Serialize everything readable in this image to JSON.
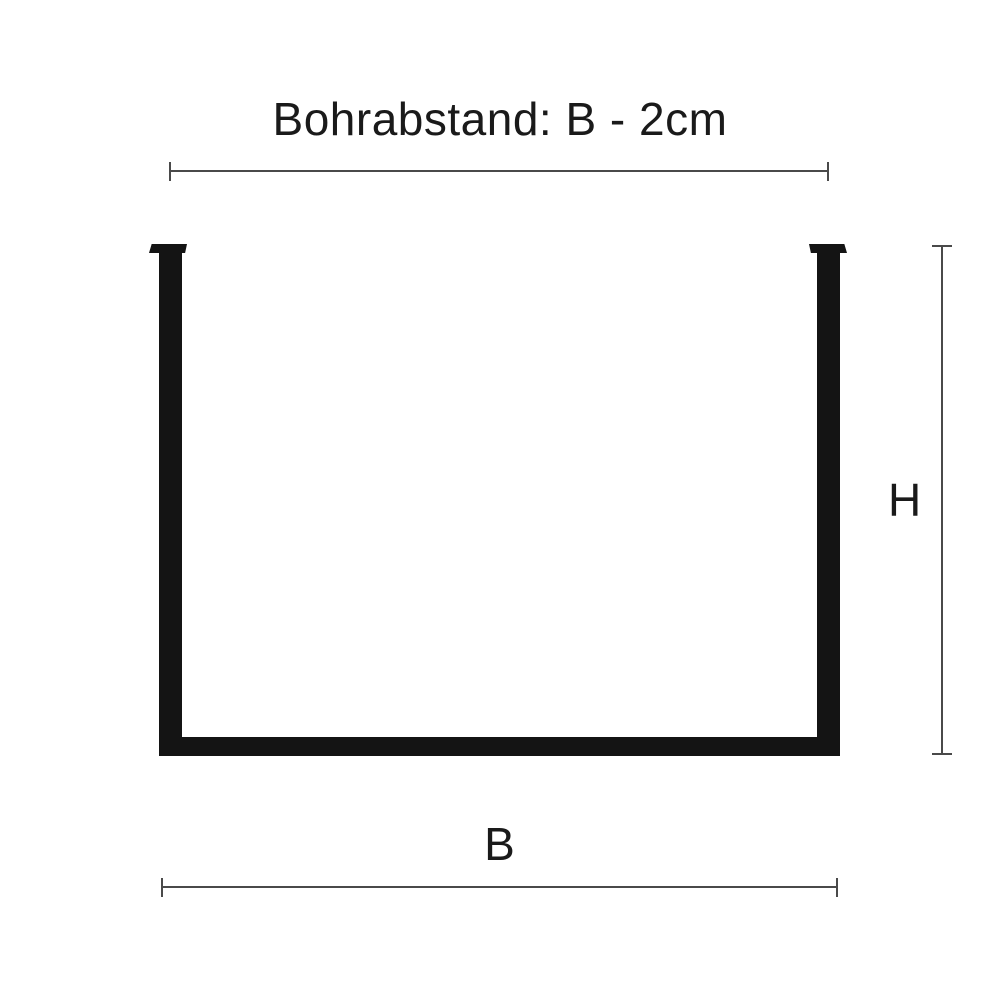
{
  "diagram": {
    "title": "Bohrabstand: B - 2cm",
    "shape_name": "u-bracket-front-view",
    "dimensions": {
      "drill_spacing": {
        "label": "Bohrabstand: B - 2cm",
        "orientation": "horizontal",
        "position": "top"
      },
      "height": {
        "label": "H",
        "orientation": "vertical",
        "position": "right"
      },
      "width": {
        "label": "B",
        "orientation": "horizontal",
        "position": "bottom"
      }
    }
  },
  "colors": {
    "bg": "#ffffff",
    "shape": "#141414",
    "dim": "#4a4a4a",
    "txt": "#1a1a1a"
  }
}
